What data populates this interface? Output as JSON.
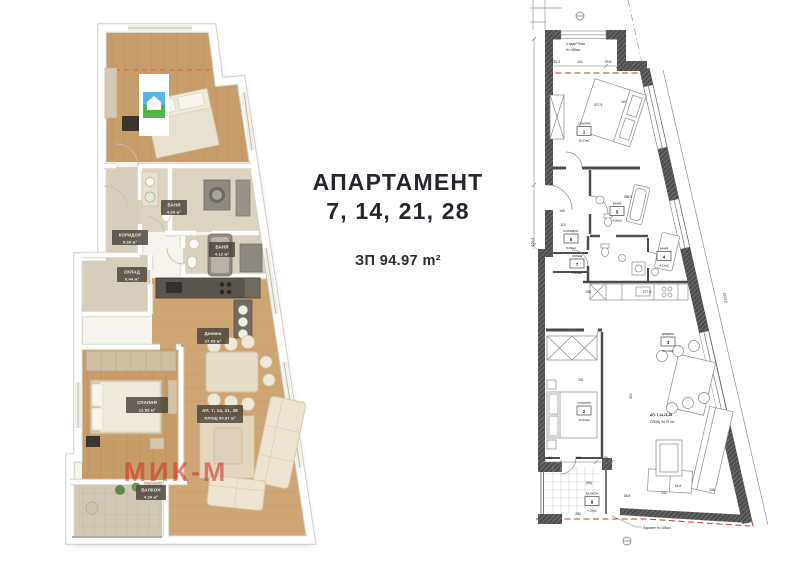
{
  "center_text": {
    "title_line1": "АПАРТАМЕНТ",
    "title_line2": "7, 14, 21, 28",
    "area": "ЗП 94.97 m²"
  },
  "render_plan": {
    "watermark": "МИК-М",
    "labels": {
      "koridor": {
        "name": "КОРИДОР",
        "area": "5.09 м²"
      },
      "sklad": {
        "name": "СКЛАД",
        "area": "0.44 м²"
      },
      "banya5": {
        "name": "БАНЯ",
        "area": "4.09 м²"
      },
      "banya4": {
        "name": "БАНЯ",
        "area": "4.12 м²"
      },
      "dnevna": {
        "name": "Дневна",
        "area": "27.03 м²"
      },
      "spalnya": {
        "name": "СПАЛНЯ",
        "area": "12.53 м²"
      },
      "balkon": {
        "name": "БАЛКОН",
        "area": "4.20 м²"
      },
      "apartment": {
        "line1": "АП. 7, 14, 21, 28",
        "line2": "ПЛОЩ 94.97 м²"
      }
    }
  },
  "cad_plan": {
    "rooms": [
      {
        "name": "СПАЛНЯ",
        "num": "1",
        "area": "16.12м2"
      },
      {
        "name": "СПАЛНЯ",
        "num": "2",
        "area": "12.53м2"
      },
      {
        "name": "ДНЕВНА",
        "num": "3",
        "area": "27.03м2"
      },
      {
        "name": "БАНЯ",
        "num": "4",
        "area": "4.12м2"
      },
      {
        "name": "БАНЯ",
        "num": "5",
        "area": "4.09м2"
      },
      {
        "name": "КОРИДОР",
        "num": "6",
        "area": "5.09м2"
      },
      {
        "name": "СКЛАД",
        "num": "7",
        "area": "0.44м2"
      },
      {
        "name": "БАЛКОН",
        "num": "8",
        "area": "4.20м2"
      }
    ],
    "apartment_label": {
      "line1": "АП. 7,14,21,28",
      "line2": "ПЛОЩ 94.97 м2"
    },
    "notes": {
      "parapet": "Парапет Н=105см",
      "stairs1": "4 сдвр*75см",
      "stairs2": "Н=+85см"
    },
    "dims": {
      "d1": "251.5",
      "d2": "162",
      "d3": "29.5",
      "d4": "327.5",
      "d5": "107",
      "d6": "140",
      "d7": "110",
      "d8": "288.5",
      "d9": "277.5",
      "d10": "136",
      "d11": "261",
      "d12": "300",
      "d13": "229.5",
      "d14": "44",
      "d15": "162",
      "d16": "50",
      "d17": "242",
      "d18": "41.6",
      "d19": "138",
      "d20": "35.5",
      "d21": "253",
      "d22": "(98)",
      "d23": "1923.5"
    }
  }
}
